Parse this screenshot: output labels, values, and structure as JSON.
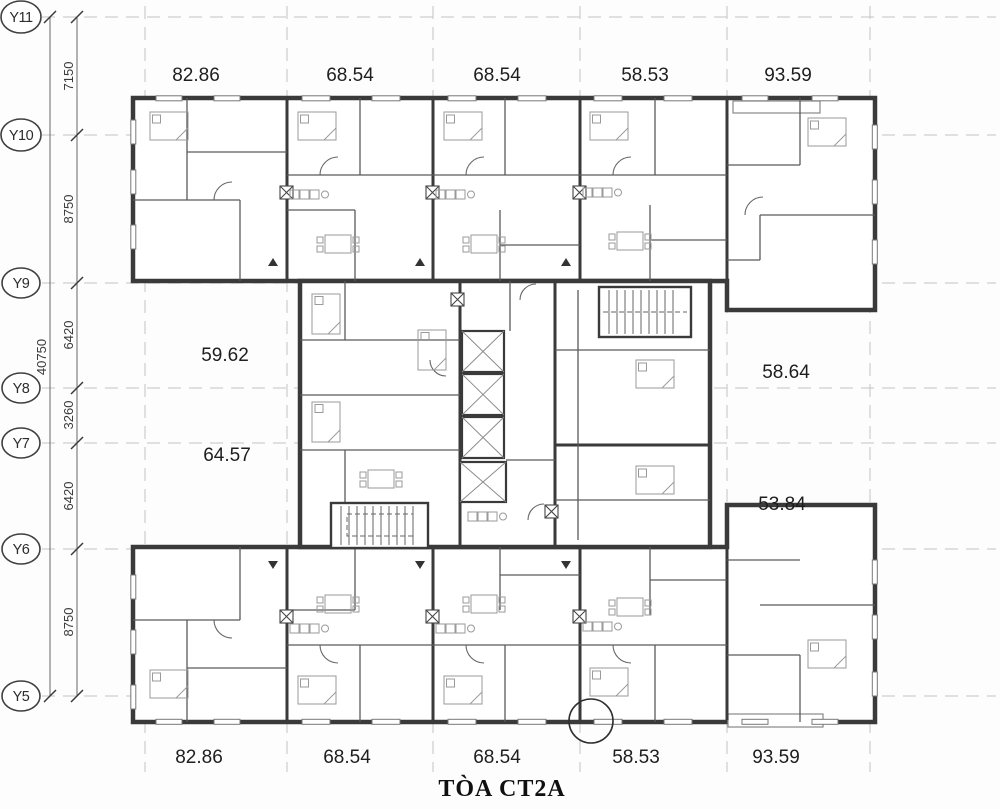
{
  "title": "TÒA CT2A",
  "colors": {
    "wall": "#3a3a3a",
    "text": "#1e1e1e",
    "grid_line": "#c4c4c4",
    "background": "#fdfdfd"
  },
  "grid": {
    "rows": [
      {
        "label": "Y11"
      },
      {
        "label": "Y10"
      },
      {
        "label": "Y9"
      },
      {
        "label": "Y8"
      },
      {
        "label": "Y7"
      },
      {
        "label": "Y6"
      },
      {
        "label": "Y5"
      }
    ],
    "segment_dimensions": [
      "7150",
      "8750",
      "6420",
      "3260",
      "6420",
      "8750"
    ],
    "overall_dimension": "40750"
  },
  "areas": {
    "top_row": [
      "82.86",
      "68.54",
      "68.54",
      "58.53",
      "93.59"
    ],
    "middle_left": [
      "59.62",
      "64.57"
    ],
    "middle_right": [
      "58.64",
      "53.84"
    ],
    "bottom_row": [
      "82.86",
      "68.54",
      "68.54",
      "58.53",
      "93.59"
    ]
  }
}
